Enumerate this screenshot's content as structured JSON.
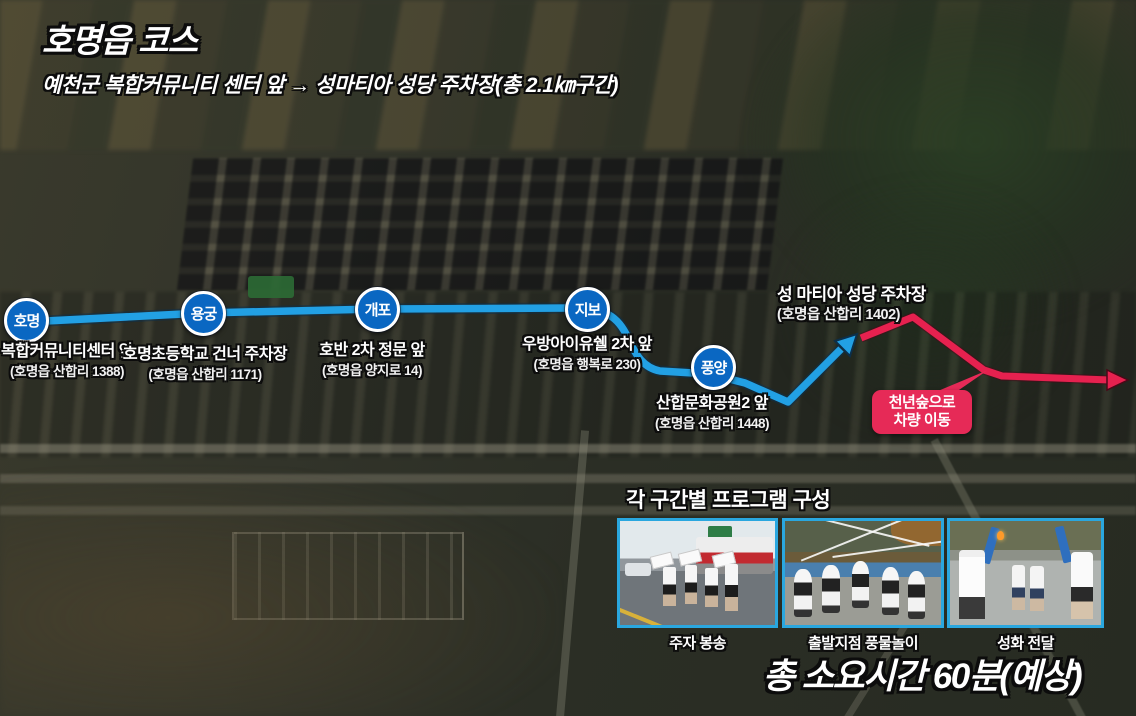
{
  "header": {
    "title": "호명읍 코스",
    "subtitle": "예천군 복합커뮤니티 센터 앞 → 성마티아 성당 주차장(총 2.1㎞구간)"
  },
  "route": {
    "colors": {
      "course_line": "#22a0e4",
      "transfer_line": "#e6214f",
      "station_fill": "#0a67c2",
      "callout_bg": "#e62a57",
      "photo_border": "#2aa7df"
    },
    "stations": [
      {
        "name": "호명",
        "label": "복합커뮤니티센터 앞",
        "address": "(호명읍 산합리 1388)"
      },
      {
        "name": "용궁",
        "label": "호명초등학교 건너 주차장",
        "address": "(호명읍 산합리 1171)"
      },
      {
        "name": "개포",
        "label": "호반 2차 정문 앞",
        "address": "(호명읍 양지로 14)"
      },
      {
        "name": "지보",
        "label": "우방아이유쉘 2차 앞",
        "address": "(호명읍 행복로 230)"
      },
      {
        "name": "풍양",
        "label": "산합문화공원2 앞",
        "address": "(호명읍 산합리 1448)"
      }
    ],
    "destination": {
      "label": "성 마티아 성당 주차장",
      "address": "(호명읍 산합리 1402)"
    },
    "transfer_callout": {
      "line1": "천년숲으로",
      "line2": "차량 이동"
    }
  },
  "program": {
    "heading": "각 구간별 프로그램 구성",
    "items": [
      {
        "caption": "주자 봉송"
      },
      {
        "caption": "출발지점 풍물놀이"
      },
      {
        "caption": "성화 전달"
      }
    ]
  },
  "footer": {
    "total_time": "총 소요시간 60분(예상)"
  }
}
